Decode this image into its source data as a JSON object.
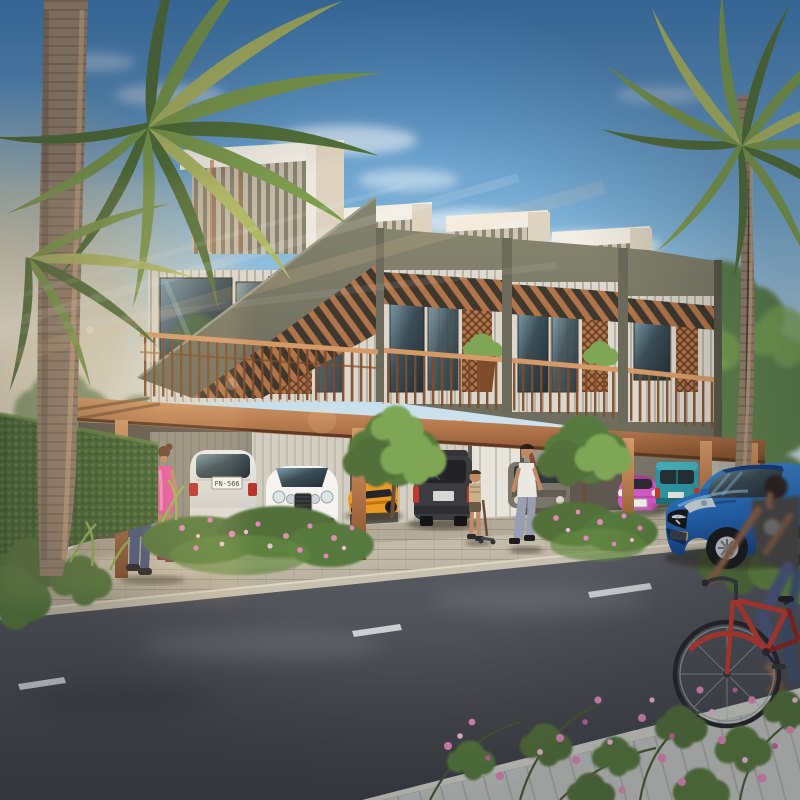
{
  "scene": {
    "description": "Photorealistic architectural rendering of a modern two-storey townhouse row with louvered roof boxes, copper balconies and a ground-floor carport; parked cars (white SUV, white coupe, orange sports car, dark SUV, pink mini, teal van), a blue sedan by the street, pedestrians, a child, a woman on a red bicycle, palm trees and flowering shrubs along an asphalt road."
  },
  "vehicles": {
    "suv_plate": "FN-566"
  },
  "palette": {
    "sky_top": "#3f7ab4",
    "sky_mid": "#79aed4",
    "sky_low": "#b9d8ea",
    "sky_horizon": "#e6eef2",
    "sun_core": "#fff6e0",
    "sun_warm": "#ffd9a0",
    "palm_green": "#7d9c4e",
    "palm_dark": "#53703a",
    "palm_yellow": "#aeb965",
    "trunk": "#98836f",
    "trunk_dark": "#6e5c4d",
    "trunk_lit": "#d8b48c",
    "facade": "#85846f",
    "facade_dark": "#6c6b5b",
    "facade_deep": "#585748",
    "roof_white": "#f3eee3",
    "roof_cream": "#ded3c0",
    "louver": "#cfc6b4",
    "louver_dark": "#8e8776",
    "copper": "#b0744a",
    "copper_light": "#d49a68",
    "copper_dark": "#7e4c2a",
    "copper_deep": "#5d3a22",
    "siding": "#dbd7cc",
    "siding_dark": "#b7b2a5",
    "glass": "#3c4d56",
    "glass_dark": "#222e34",
    "glass_light": "#7fa0ad",
    "wall_shadow": "#5e584e",
    "wall_mid": "#7b7569",
    "wall_light": "#cac5b8",
    "door_white": "#e7e4db",
    "hedge": "#416233",
    "hedge_light": "#648a42",
    "grass": "#6f9048",
    "leaf": "#577a3c",
    "leaf_light": "#7fa654",
    "ground": "#cfc7b5",
    "ground_dark": "#b3ab99",
    "road": "#5a5c63",
    "road_dark": "#3c3e44",
    "curb": "#c8c0ae",
    "lane": "#d9dde0",
    "walk": "#c4c7c3",
    "suv_white": "#ededeb",
    "suv_white_dark": "#c9c9c4",
    "bentley": "#f5f4f1",
    "camaro": "#eb9a25",
    "camaro_dark": "#c07410",
    "suv_dark": "#3c3c40",
    "suv_dark2": "#232327",
    "suv_grey": "#7b766c",
    "pink": "#d659c6",
    "pink_dark": "#a63f98",
    "teal": "#2f9aa4",
    "teal_dark": "#1f727c",
    "mazda": "#3a86d4",
    "mazda_mid": "#2468b8",
    "mazda_dark": "#173f80",
    "chrome": "#ccd4d8",
    "tire": "#1a1b1e",
    "rim": "#c3c8cc",
    "bike_red": "#c63b30",
    "bike_dark": "#8e241c",
    "skin": "#c08b64",
    "skin_dark": "#8a6048",
    "hair_dark": "#2a211c",
    "hair_brown": "#6b4530",
    "hair_auburn": "#8a4f33",
    "shirt_blue": "#5d6ca4",
    "jeans": "#4d5880",
    "dress": "#e85a9e",
    "dress_light": "#f59ec6",
    "top_white": "#ebe8e2",
    "pants": "#97a0b2",
    "tee_grey": "#4b4947",
    "flower": "#e18ab8",
    "flower_light": "#f2bcd6",
    "flower_deep": "#c2679e",
    "shadow": "#2e2a23"
  }
}
